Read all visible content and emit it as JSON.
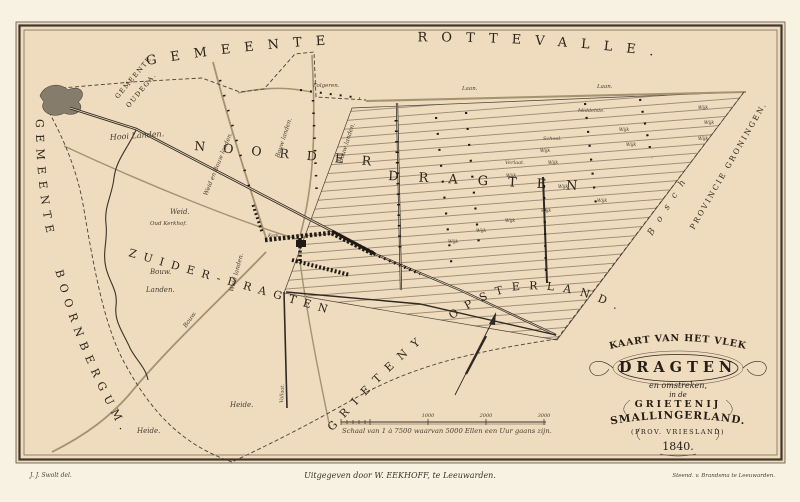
{
  "map_sheet": {
    "publisher": "Uitgegeven door W. EEKHOFF, te Leeuwarden.",
    "drawn_by": "J. J. Swolt del.",
    "lithographer": "Steend. v. Brandsma te Leeuwarden.",
    "colors": {
      "paper": "#efdbbd",
      "margin": "#f8f2e3",
      "ink": "#3b332a",
      "road": "#a6926f",
      "water": "#867c6b"
    }
  },
  "cartouche": {
    "line1": "KAART VAN HET VLEK",
    "place": "DRAGTEN",
    "line2": "en omstreken,",
    "line3": "in de",
    "line4": "GRIETENIJ",
    "line5": "SMALLINGERLAND.",
    "line6": "(PROV. VRIESLAND)",
    "year": "1840."
  },
  "boundaries": {
    "north": "GEMEENTE ROTTEVALLE.",
    "northwest_1": "GEMEENTE",
    "northwest_2": "OUDEGA.",
    "west": "GEMEENTE BOORNBERGUM.",
    "east": "PROVINCIE GRONINGEN.",
    "south": "GRIETENY OPSTERLAND."
  },
  "districts": {
    "noorder": "NOORDER",
    "dragten": "DRAGTEN",
    "zuider": "ZUIDER-DRAGTEN",
    "bosch": "Bosch"
  },
  "scale_bar": {
    "caption": "Schaal van 1 à 7500 waarvan 5000 Ellen een Uur gaans zijn.",
    "tick1": "1000",
    "tick2": "2000",
    "tick3": "3000"
  },
  "labels": {
    "hooi_landen": "Hooi Landen.",
    "weid_en_bouw_landen": "Weid en Bouw landen.",
    "bouw_landen": "Bouw landen.",
    "weid_landen": "Weid landen.",
    "weid": "Weid.",
    "bouw": "Bouw.",
    "landen": "Landen.",
    "heide": "Heide.",
    "oud_kerkhof": "Oud Kerkhof.",
    "folgeren": "Folgeren.",
    "laan": "Laan.",
    "school": "School.",
    "middelste": "Middelste.",
    "verlaat": "Verlaat.",
    "vallaat": "Vallaat.",
    "kerk": "Kerk.",
    "wijk": "Wijk"
  }
}
